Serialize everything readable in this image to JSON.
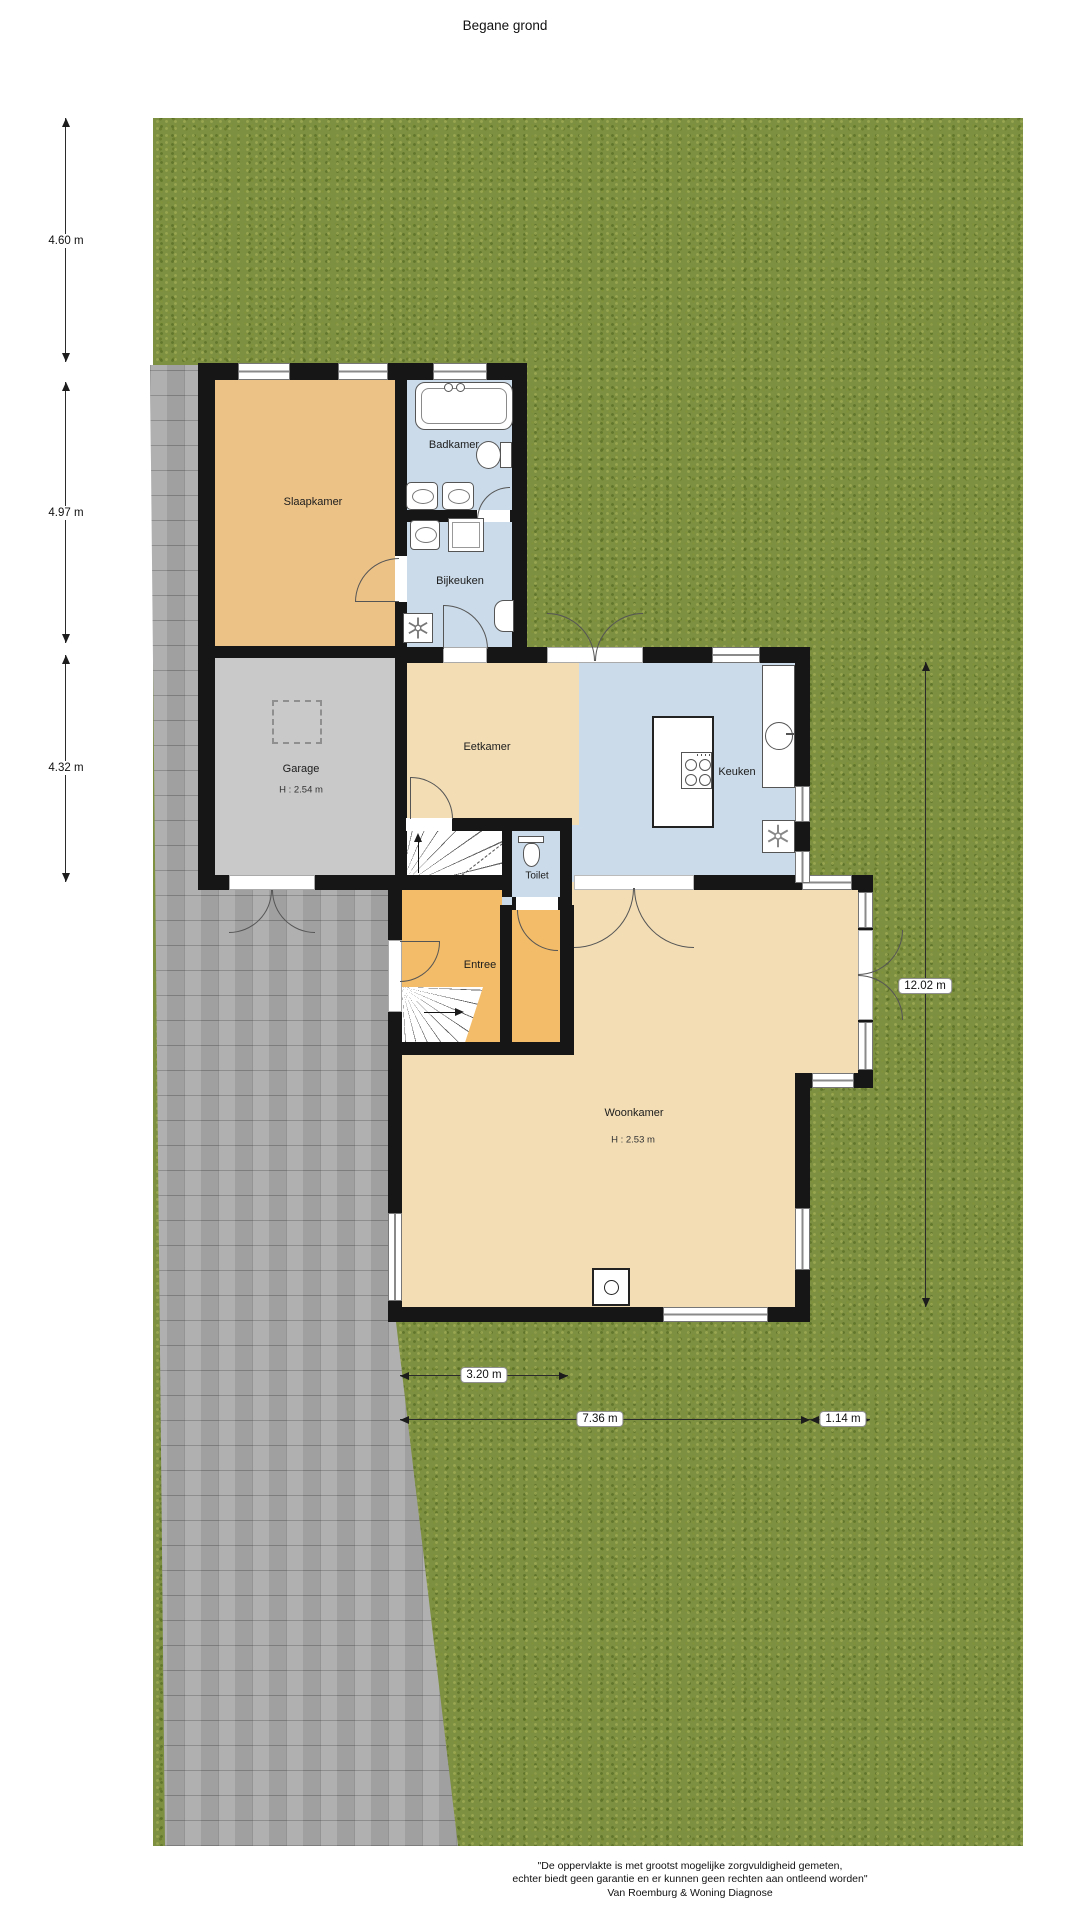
{
  "title": "Begane grond",
  "rooms": {
    "slaapkamer": "Slaapkamer",
    "badkamer": "Badkamer",
    "bijkeuken": "Bijkeuken",
    "garage": "Garage",
    "garage_height": "H : 2.54 m",
    "eetkamer": "Eetkamer",
    "keuken": "Keuken",
    "toilet": "Toilet",
    "entree": "Entree",
    "woonkamer": "Woonkamer",
    "woonkamer_height": "H : 2.53 m"
  },
  "dimensions": {
    "left_top": "4.60 m",
    "left_middle": "4.97 m",
    "left_bottom": "4.32 m",
    "right_side": "12.02 m",
    "bottom_inner": "3.20 m",
    "bottom_main": "7.36 m",
    "bottom_right": "1.14 m"
  },
  "footer": {
    "line1": "\"De oppervlakte is met grootst mogelijke zorgvuldigheid gemeten,",
    "line2": "echter biedt geen garantie en er kunnen geen rechten aan ontleend worden\"",
    "line3": "Van Roemburg & Woning Diagnose"
  },
  "colors": {
    "grass": "#7d8f41",
    "paving": "#a9a9a9",
    "wall": "#161616",
    "bedroom-orange": "#ecc287",
    "hall-orange": "#f3bc68",
    "living-tan": "#f2ddb5",
    "wet-blue": "#cbdbe9",
    "garage-gray": "#c9c9c9"
  }
}
